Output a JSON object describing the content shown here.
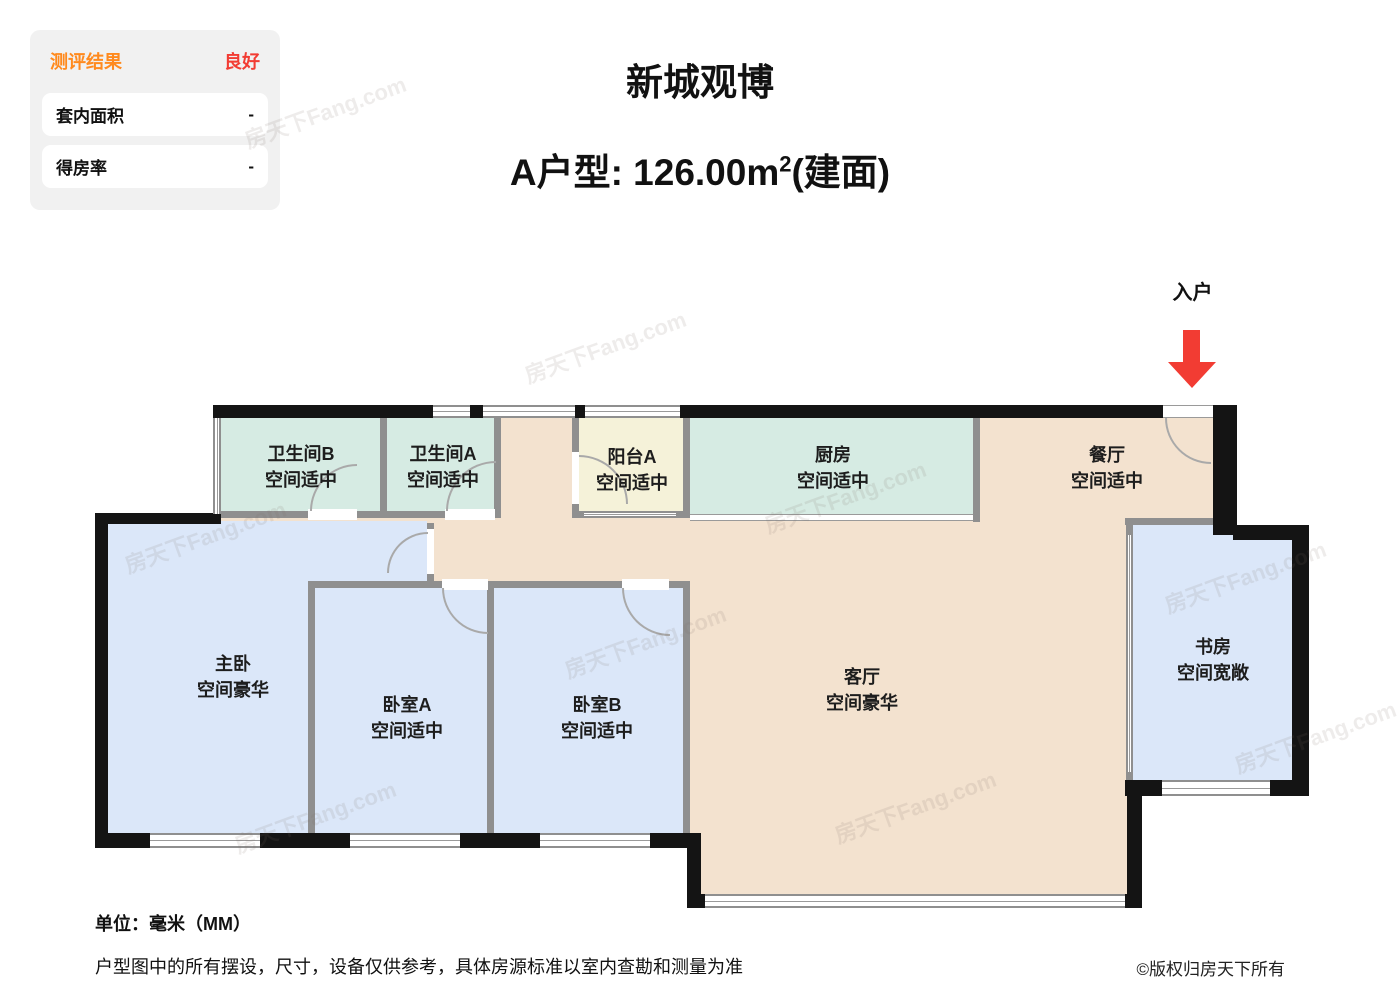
{
  "panel": {
    "title": "测评结果",
    "rating": "良好",
    "rows": [
      {
        "label": "套内面积",
        "value": "-"
      },
      {
        "label": "得房率",
        "value": "-"
      }
    ]
  },
  "header": {
    "project": "新城观博",
    "unit_type_prefix": "A户型: 126.00m",
    "area_sup": "2",
    "area_suffix": "(建面)"
  },
  "plan": {
    "entrance_label": "入户",
    "rooms": [
      {
        "id": "bathroom-b",
        "name": "卫生间B",
        "desc": "空间适中"
      },
      {
        "id": "bathroom-a",
        "name": "卫生间A",
        "desc": "空间适中"
      },
      {
        "id": "balcony-a",
        "name": "阳台A",
        "desc": "空间适中"
      },
      {
        "id": "kitchen",
        "name": "厨房",
        "desc": "空间适中"
      },
      {
        "id": "dining",
        "name": "餐厅",
        "desc": "空间适中"
      },
      {
        "id": "master-bedroom",
        "name": "主卧",
        "desc": "空间豪华"
      },
      {
        "id": "bedroom-a",
        "name": "卧室A",
        "desc": "空间适中"
      },
      {
        "id": "bedroom-b",
        "name": "卧室B",
        "desc": "空间适中"
      },
      {
        "id": "living-room",
        "name": "客厅",
        "desc": "空间豪华"
      },
      {
        "id": "study",
        "name": "书房",
        "desc": "空间宽敞"
      }
    ]
  },
  "footer": {
    "unit": "单位：毫米（MM）",
    "disclaimer": "户型图中的所有摆设，尺寸，设备仅供参考，具体房源标准以室内查勘和测量为准",
    "copyright": "©版权归房天下所有"
  },
  "watermark": "房天下Fang.com",
  "colors": {
    "accent_orange": "#ff8a1e",
    "accent_red": "#f23c33",
    "room_teal": "#d6ebe3",
    "room_blue": "#dbe7f9",
    "room_tan": "#f3e2cf",
    "room_yellow": "#f5f2d9",
    "wall_black": "#141414",
    "wall_gray": "#8f8f8f"
  }
}
